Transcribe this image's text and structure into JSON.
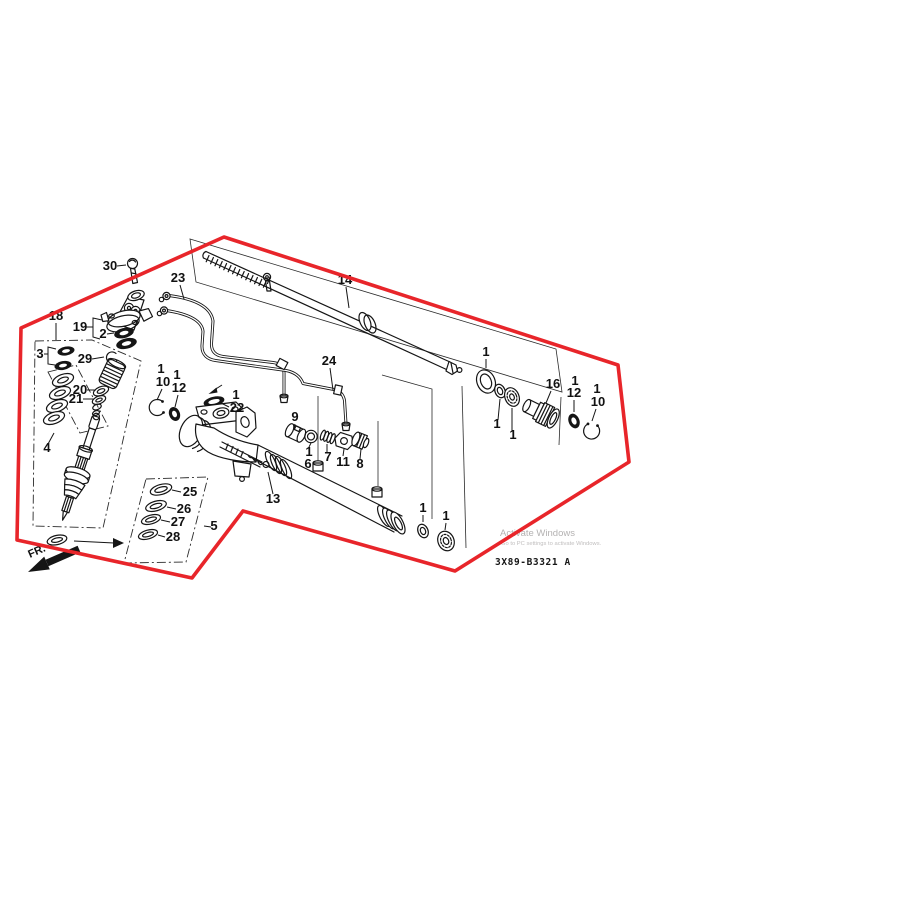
{
  "image": {
    "width": 900,
    "height": 900,
    "background": "#ffffff",
    "kind": "exploded-parts-diagram"
  },
  "colors": {
    "boundary_red": "#e8252a",
    "ink": "#151515",
    "watermark_gray": "#b4b2b2"
  },
  "diagram": {
    "code": "3X89-B3321 A",
    "fr_label": "FR.",
    "watermark": {
      "line1": "Activate Windows",
      "line2": "Go to PC settings to activate Windows."
    },
    "callouts": {
      "c30": "30",
      "c23": "23",
      "c14": "14",
      "c18": "18",
      "c19": "19",
      "c2": "2",
      "c3": "3",
      "c29": "29",
      "c20": "20",
      "c21": "21",
      "c4": "4",
      "cL1": "1",
      "cL10": "10",
      "cL1b": "1",
      "cL12": "12",
      "cM1": "1",
      "c22": "22",
      "c9": "9",
      "cV1": "1",
      "c6": "6",
      "c7": "7",
      "c11": "11",
      "c8": "8",
      "c13": "13",
      "c24": "24",
      "c25": "25",
      "c26": "26",
      "c27": "27",
      "c28": "28",
      "c5": "5",
      "cT1a": "1",
      "cT1b": "1",
      "cR1a": "1",
      "cR1b": "1",
      "cR1c": "1",
      "c16": "16",
      "cR1d": "1",
      "cR12": "12",
      "cR1e": "1",
      "cR10": "10"
    }
  }
}
